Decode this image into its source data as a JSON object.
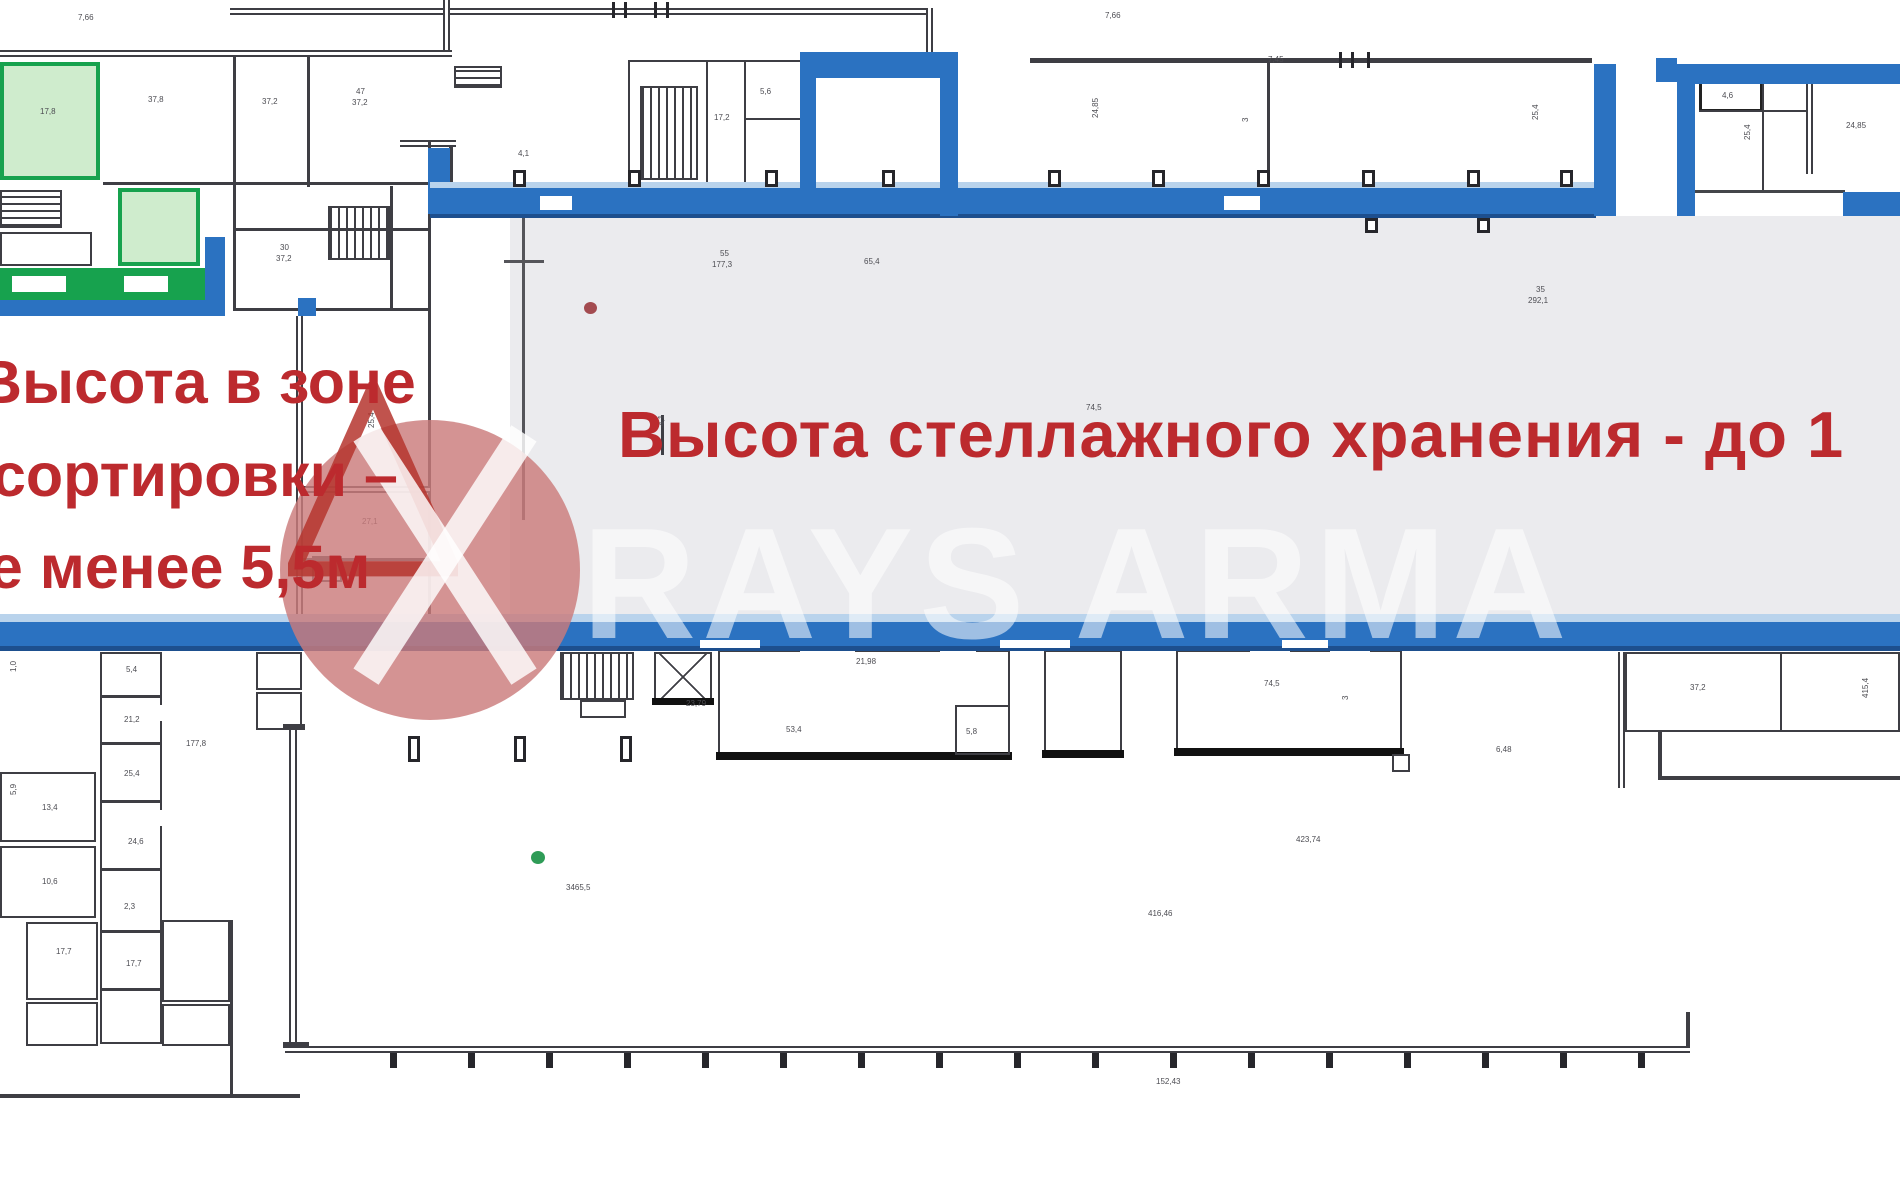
{
  "annotations": {
    "sorting_zone": {
      "l1": "Высота в зоне",
      "l2": "сортировки –",
      "l3": "не менее 5,5м"
    },
    "storage": {
      "text": "Высота стеллажного хранения - до 1"
    }
  },
  "watermark": {
    "brand": "RAYS ARMA"
  },
  "markers": {
    "red_dot": {
      "x": 584,
      "y": 302,
      "color": "#a34b50"
    },
    "green_dot": {
      "x": 531,
      "y": 851,
      "color": "#2f9c57"
    }
  },
  "colors": {
    "wall_blue": "#2b72c1",
    "wall_blue_dark": "#1d4f8e",
    "wall_blue_light": "#b9d3ec",
    "green": "#17a24e",
    "green_fill": "#cfeccd",
    "gray_zone": "#ebebee",
    "red_text": "#bc2a2e",
    "watermark_pink": "#cb7b7b",
    "line": "#3e3e44"
  },
  "labels": [
    {
      "x": 78,
      "y": 14,
      "t": "7,66"
    },
    {
      "x": 1105,
      "y": 12,
      "t": "7,66"
    },
    {
      "x": 1268,
      "y": 56,
      "t": "7,45"
    },
    {
      "x": 148,
      "y": 96,
      "t": "37,8"
    },
    {
      "x": 40,
      "y": 108,
      "t": "17,8"
    },
    {
      "x": 262,
      "y": 98,
      "t": "37,2"
    },
    {
      "x": 356,
      "y": 88,
      "t": "47"
    },
    {
      "x": 352,
      "y": 99,
      "t": "37,2"
    },
    {
      "x": 280,
      "y": 244,
      "t": "30"
    },
    {
      "x": 276,
      "y": 255,
      "t": "37,2"
    },
    {
      "x": 714,
      "y": 114,
      "t": "17,2"
    },
    {
      "x": 760,
      "y": 88,
      "t": "5,6"
    },
    {
      "x": 518,
      "y": 150,
      "t": "4,1"
    },
    {
      "x": 1092,
      "y": 118,
      "t": "24,85",
      "r": 1
    },
    {
      "x": 1242,
      "y": 122,
      "t": "3",
      "r": 1
    },
    {
      "x": 1532,
      "y": 120,
      "t": "25,4",
      "r": 1
    },
    {
      "x": 1722,
      "y": 92,
      "t": "4,6"
    },
    {
      "x": 1744,
      "y": 140,
      "t": "25,4",
      "r": 1
    },
    {
      "x": 1846,
      "y": 122,
      "t": "24,85"
    },
    {
      "x": 720,
      "y": 250,
      "t": "55"
    },
    {
      "x": 712,
      "y": 261,
      "t": "177,3"
    },
    {
      "x": 864,
      "y": 258,
      "t": "65,4"
    },
    {
      "x": 1536,
      "y": 286,
      "t": "35"
    },
    {
      "x": 1528,
      "y": 297,
      "t": "292,1"
    },
    {
      "x": 1086,
      "y": 404,
      "t": "74,5"
    },
    {
      "x": 658,
      "y": 426,
      "t": "4,1",
      "r": 1
    },
    {
      "x": 368,
      "y": 428,
      "t": "25,4",
      "r": 1
    },
    {
      "x": 362,
      "y": 518,
      "t": "27,1"
    },
    {
      "x": 856,
      "y": 658,
      "t": "21,98"
    },
    {
      "x": 786,
      "y": 726,
      "t": "53,4"
    },
    {
      "x": 966,
      "y": 728,
      "t": "5,8"
    },
    {
      "x": 1264,
      "y": 680,
      "t": "74,5"
    },
    {
      "x": 1496,
      "y": 746,
      "t": "6,48"
    },
    {
      "x": 1690,
      "y": 684,
      "t": "37,2"
    },
    {
      "x": 1862,
      "y": 698,
      "t": "415,4",
      "r": 1
    },
    {
      "x": 1342,
      "y": 700,
      "t": "3",
      "r": 1
    },
    {
      "x": 686,
      "y": 700,
      "t": "23,79"
    },
    {
      "x": 126,
      "y": 666,
      "t": "5,4"
    },
    {
      "x": 124,
      "y": 716,
      "t": "21,2"
    },
    {
      "x": 124,
      "y": 770,
      "t": "25,4"
    },
    {
      "x": 128,
      "y": 838,
      "t": "24,6"
    },
    {
      "x": 124,
      "y": 903,
      "t": "2,3"
    },
    {
      "x": 126,
      "y": 960,
      "t": "17,7"
    },
    {
      "x": 186,
      "y": 740,
      "t": "177,8"
    },
    {
      "x": 42,
      "y": 804,
      "t": "13,4"
    },
    {
      "x": 42,
      "y": 878,
      "t": "10,6"
    },
    {
      "x": 56,
      "y": 948,
      "t": "17,7"
    },
    {
      "x": 566,
      "y": 884,
      "t": "3465,5"
    },
    {
      "x": 1148,
      "y": 910,
      "t": "416,46"
    },
    {
      "x": 1296,
      "y": 836,
      "t": "423,74"
    },
    {
      "x": 1156,
      "y": 1078,
      "t": "152,43"
    },
    {
      "x": 10,
      "y": 672,
      "t": "1,0",
      "r": 1
    },
    {
      "x": 10,
      "y": 795,
      "t": "5,9",
      "r": 1
    }
  ]
}
